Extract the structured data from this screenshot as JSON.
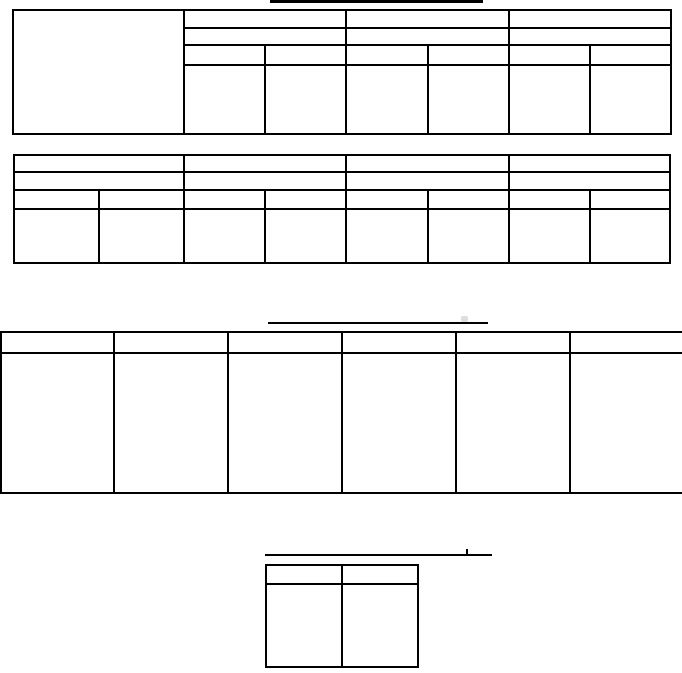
{
  "page": {
    "kind": "scanned blank form with empty ruled tables",
    "colors": {
      "background": "#ffffff",
      "line": "#000000"
    }
  },
  "rules": {
    "top_title_underline": "",
    "middle_title_underline": "",
    "bottom_title_underline": ""
  },
  "tables": {
    "table1": {
      "left_cell": "",
      "group_headers": [
        "",
        "",
        ""
      ],
      "subgroup_row": [
        "",
        "",
        ""
      ],
      "column_headers": [
        "",
        "",
        "",
        "",
        "",
        ""
      ],
      "data_row": [
        "",
        "",
        "",
        "",
        "",
        ""
      ]
    },
    "table2": {
      "group_headers": [
        "",
        "",
        "",
        ""
      ],
      "subgroup_row": [
        "",
        "",
        "",
        ""
      ],
      "column_headers": [
        "",
        "",
        "",
        "",
        "",
        "",
        "",
        ""
      ],
      "data_row": [
        "",
        "",
        "",
        "",
        "",
        "",
        "",
        ""
      ]
    },
    "table3": {
      "column_headers": [
        "",
        "",
        "",
        "",
        "",
        ""
      ],
      "data_row": [
        "",
        "",
        "",
        "",
        "",
        ""
      ]
    },
    "table4": {
      "column_headers": [
        "",
        ""
      ],
      "data_row": [
        "",
        ""
      ]
    }
  }
}
